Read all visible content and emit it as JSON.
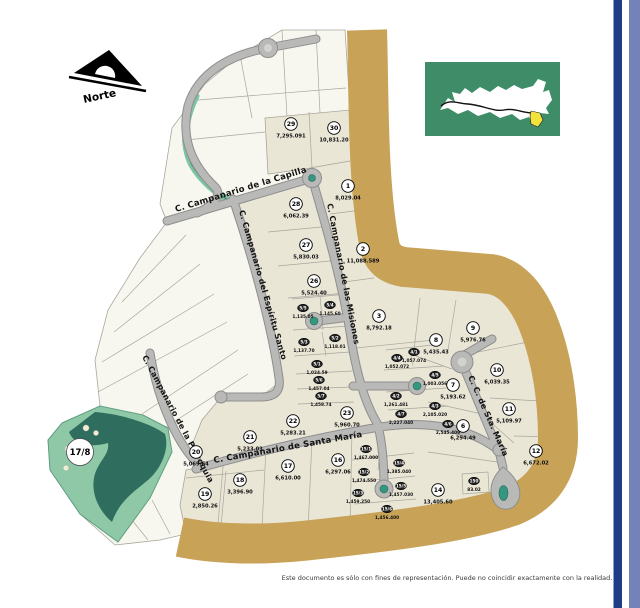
{
  "north_arrow": {
    "label": "Norte"
  },
  "park": {
    "label": "17/8"
  },
  "disclaimer": "Este documento es sólo con fines de representación. Puede no coincidir exactamente con la realidad.",
  "streets": [
    {
      "name": "C. Campanario de la Capilla"
    },
    {
      "name": "C. Campanario del Espíritu Santo"
    },
    {
      "name": "C. Campanario de las Misiones"
    },
    {
      "name": "C. Campanario de la Parroquia"
    },
    {
      "name": "C. Campanario de Santa María"
    },
    {
      "name": "C. C. de Sta. María"
    }
  ],
  "lots": [
    {
      "id": "29",
      "area": "7,295.091",
      "x": 291,
      "y": 124,
      "size": "large"
    },
    {
      "id": "30",
      "area": "10,831.20",
      "x": 334,
      "y": 128,
      "size": "large"
    },
    {
      "id": "1",
      "area": "8,029.04",
      "x": 348,
      "y": 186,
      "size": "large"
    },
    {
      "id": "28",
      "area": "6,062.39",
      "x": 296,
      "y": 204,
      "size": "large"
    },
    {
      "id": "27",
      "area": "5,830.03",
      "x": 306,
      "y": 245,
      "size": "large"
    },
    {
      "id": "2",
      "area": "11,088.589",
      "x": 363,
      "y": 249,
      "size": "large"
    },
    {
      "id": "26",
      "area": "5,524.40",
      "x": 314,
      "y": 281,
      "size": "large"
    },
    {
      "id": "3",
      "area": "8,792.18",
      "x": 379,
      "y": 316,
      "size": "large"
    },
    {
      "id": "8",
      "area": "5,435.43",
      "x": 436,
      "y": 340,
      "size": "large"
    },
    {
      "id": "9",
      "area": "5,976.76",
      "x": 473,
      "y": 328,
      "size": "large"
    },
    {
      "id": "10",
      "area": "6,039.35",
      "x": 497,
      "y": 370,
      "size": "large"
    },
    {
      "id": "7",
      "area": "5,193.62",
      "x": 453,
      "y": 385,
      "size": "large"
    },
    {
      "id": "11",
      "area": "5,109.97",
      "x": 509,
      "y": 409,
      "size": "large"
    },
    {
      "id": "6",
      "area": "6,294.49",
      "x": 463,
      "y": 426,
      "size": "large"
    },
    {
      "id": "12",
      "area": "6,672.02",
      "x": 536,
      "y": 451,
      "size": "large"
    },
    {
      "id": "14",
      "area": "13,405.60",
      "x": 438,
      "y": 490,
      "size": "large"
    },
    {
      "id": "23",
      "area": "5,960.70",
      "x": 347,
      "y": 413,
      "size": "large"
    },
    {
      "id": "22",
      "area": "5,283.21",
      "x": 293,
      "y": 421,
      "size": "large"
    },
    {
      "id": "21",
      "area": "5,233.03",
      "x": 250,
      "y": 437,
      "size": "large"
    },
    {
      "id": "20",
      "area": "5,069.64",
      "x": 196,
      "y": 452,
      "size": "large"
    },
    {
      "id": "16",
      "area": "6,297.06",
      "x": 338,
      "y": 460,
      "size": "large"
    },
    {
      "id": "17",
      "area": "6,610.00",
      "x": 288,
      "y": 466,
      "size": "large"
    },
    {
      "id": "18",
      "area": "3,396.90",
      "x": 240,
      "y": 480,
      "size": "large"
    },
    {
      "id": "19",
      "area": "2,850.26",
      "x": 205,
      "y": 494,
      "size": "large"
    },
    {
      "id": "5/5",
      "area": "1,135.05",
      "x": 303,
      "y": 308,
      "size": "small"
    },
    {
      "id": "5/4",
      "area": "1,145.60",
      "x": 330,
      "y": 305,
      "size": "small"
    },
    {
      "id": "5/3",
      "area": "1,137.70",
      "x": 304,
      "y": 342,
      "size": "small"
    },
    {
      "id": "5/2",
      "area": "1,118.01",
      "x": 335,
      "y": 338,
      "size": "small"
    },
    {
      "id": "5/1",
      "area": "1,024.59",
      "x": 317,
      "y": 364,
      "size": "small"
    },
    {
      "id": "5/6",
      "area": "1,457.04",
      "x": 319,
      "y": 380,
      "size": "small"
    },
    {
      "id": "5/7",
      "area": "1,458.74",
      "x": 321,
      "y": 396,
      "size": "small"
    },
    {
      "id": "4/4",
      "area": "1,052.072",
      "x": 397,
      "y": 358,
      "size": "small"
    },
    {
      "id": "4/1",
      "area": "1,057.074",
      "x": 414,
      "y": 352,
      "size": "small"
    },
    {
      "id": "4/5",
      "area": "1,003.056",
      "x": 435,
      "y": 375,
      "size": "small"
    },
    {
      "id": "4/2",
      "area": "1,261.481",
      "x": 396,
      "y": 396,
      "size": "small"
    },
    {
      "id": "4/7",
      "area": "2,227.040",
      "x": 401,
      "y": 414,
      "size": "small"
    },
    {
      "id": "4/3",
      "area": "2,105.020",
      "x": 435,
      "y": 406,
      "size": "small"
    },
    {
      "id": "4/6",
      "area": "2,545.409",
      "x": 448,
      "y": 424,
      "size": "small"
    },
    {
      "id": "15/1",
      "area": "1,467.000",
      "x": 366,
      "y": 449,
      "size": "small"
    },
    {
      "id": "15/4",
      "area": "1,385.040",
      "x": 399,
      "y": 463,
      "size": "small"
    },
    {
      "id": "15/2",
      "area": "1,474.550",
      "x": 364,
      "y": 472,
      "size": "small"
    },
    {
      "id": "15/5",
      "area": "1,457.030",
      "x": 401,
      "y": 486,
      "size": "small"
    },
    {
      "id": "15/3",
      "area": "1,459.250",
      "x": 358,
      "y": 493,
      "size": "small"
    },
    {
      "id": "15/6",
      "area": "1,456.400",
      "x": 387,
      "y": 509,
      "size": "small"
    },
    {
      "id": "150",
      "area": "83.02",
      "x": 474,
      "y": 481,
      "size": "small"
    },
    {
      "id": "17/8",
      "area": "",
      "x": 80,
      "y": 452,
      "size": "park"
    }
  ],
  "colors": {
    "lot_beige": "#eae6d6",
    "lot_white": "#f8f7ef",
    "perimeter_tan": "#c7a257",
    "road_gray": "#b9b9b7",
    "park_green": "#8fc8a6",
    "park_dark_green": "#2f6e5e",
    "creek_teal": "#7cc4a4",
    "culdesac_green": "#35977f",
    "inset_green": "#3e8c68",
    "inset_highlight_yellow": "#f2e33c",
    "stripe_dark_blue": "#1f3c87",
    "stripe_light_blue": "#7383b8"
  }
}
